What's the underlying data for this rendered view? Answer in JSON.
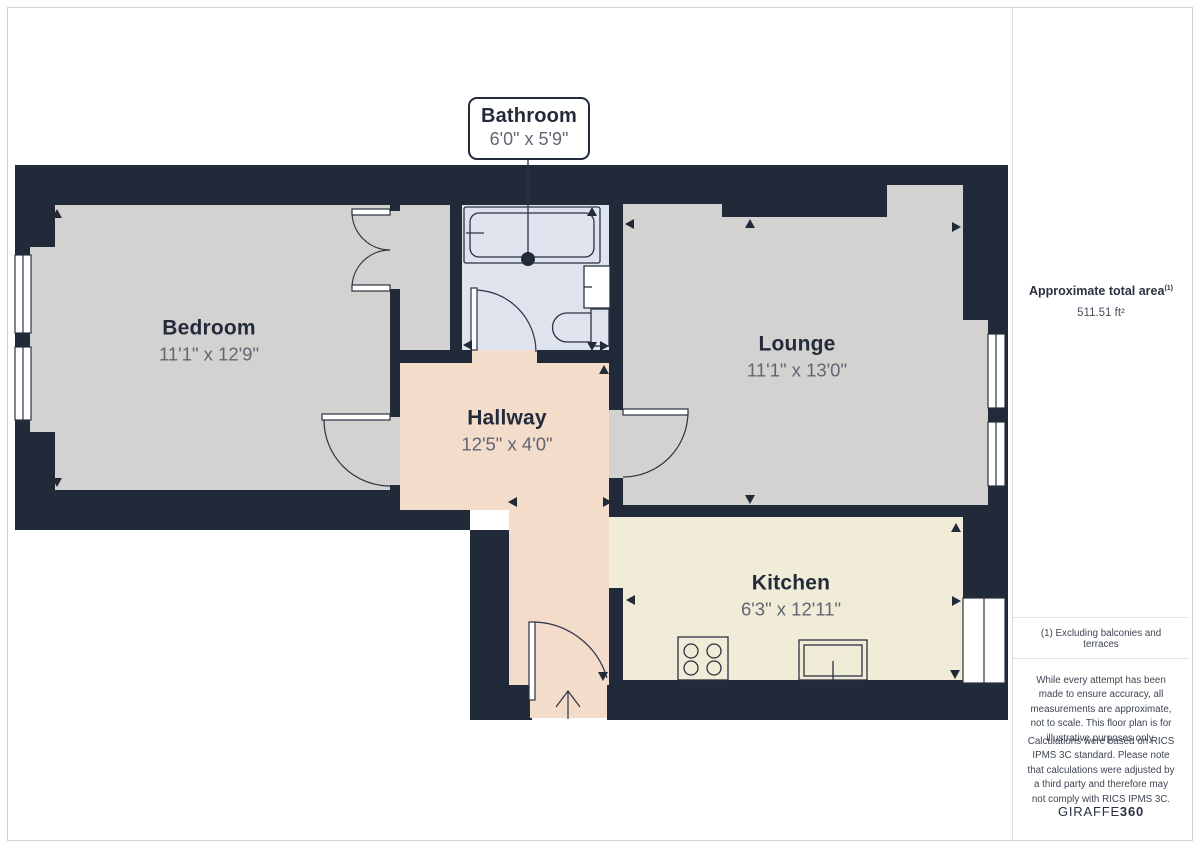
{
  "plan": {
    "rooms": [
      {
        "name": "Bedroom",
        "dims": "11'1\" x 12'9\""
      },
      {
        "name": "Bathroom",
        "dims": "6'0\" x 5'9\""
      },
      {
        "name": "Lounge",
        "dims": "11'1\" x 13'0\""
      },
      {
        "name": "Hallway",
        "dims": "12'5\" x 4'0\""
      },
      {
        "name": "Kitchen",
        "dims": "6'3\" x 12'11\""
      }
    ],
    "colors": {
      "wall": "#212a38",
      "floor_gray": "#d3d2d1",
      "floor_bathroom": "#dfe3ee",
      "floor_hallway": "#f4dccb",
      "floor_kitchen": "#f1ecd8",
      "room_name_text": "#232b3a",
      "room_dims_text": "#606672"
    }
  },
  "sidebar": {
    "total_area_label": "Approximate total area",
    "total_area_footnote_marker": "(1)",
    "total_area_value": "511.51 ft²",
    "footnote": "(1) Excluding balconies and terraces",
    "disclaimer1": "While every attempt has been made to ensure accuracy, all measurements are approximate, not to scale. This floor plan is for illustrative purposes only.",
    "disclaimer2": "Calculations were based on RICS IPMS 3C standard. Please note that calculations were adjusted by a third party and therefore may not comply with RICS IPMS 3C.",
    "brand_name": "GIRAFFE",
    "brand_suffix": "360"
  }
}
